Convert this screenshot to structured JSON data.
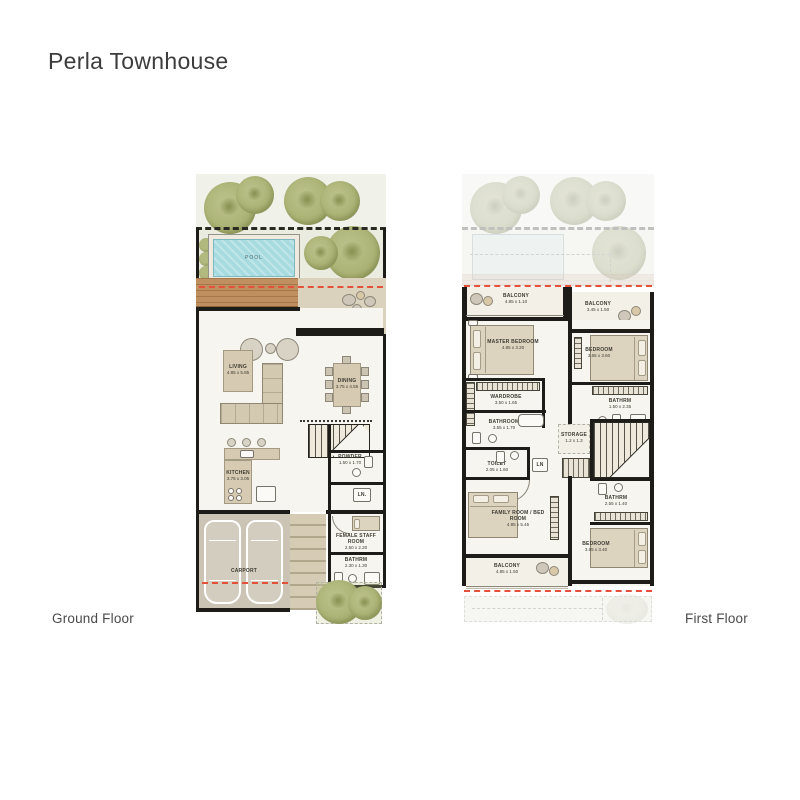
{
  "title": "Perla Townhouse",
  "floors": {
    "ground": {
      "name": "Ground Floor"
    },
    "first": {
      "name": "First Floor"
    }
  },
  "ground": {
    "pool": {
      "label": "POOL"
    },
    "living": {
      "label": "LIVING",
      "dims": "4.85 x 5.85"
    },
    "dining": {
      "label": "DINING",
      "dims": "3.75 x 4.55"
    },
    "kitchen": {
      "label": "KITCHEN",
      "dims": "3.75 x 3.05"
    },
    "powder": {
      "label": "POWDER",
      "dims": "1.50 x 1.70"
    },
    "linen": {
      "label": "LN."
    },
    "staff_room": {
      "label": "FEMALE STAFF ROOM",
      "dims": "2.50 x 2.20"
    },
    "bathroom": {
      "label": "BATHRM",
      "dims": "2.30 x 1.30"
    },
    "carport": {
      "label": "CARPORT"
    }
  },
  "first": {
    "balcony_front": {
      "label": "BALCONY",
      "dims": "4.85 x 1.10"
    },
    "balcony_front_right": {
      "label": "BALCONY",
      "dims": "3.45 x 1.50"
    },
    "master_bedroom": {
      "label": "MASTER BEDROOM",
      "dims": "4.85 x 3.20"
    },
    "bedroom_2": {
      "label": "BEDROOM",
      "dims": "3.65 x 3.60"
    },
    "wardrobe": {
      "label": "WARDROBE",
      "dims": "3.50 x 1.65"
    },
    "bathroom_master": {
      "label": "BATHROOM",
      "dims": "3.55 x 1.70"
    },
    "toilet": {
      "label": "TOILET",
      "dims": "2.05 x 1.60"
    },
    "linen": {
      "label": "LN"
    },
    "storage": {
      "label": "STORAGE",
      "dims": "1.2 x 1.3"
    },
    "bathroom_2": {
      "label": "BATHRM",
      "dims": "1.50 x 2.35"
    },
    "bathroom_3": {
      "label": "BATHRM",
      "dims": "2.55 x 1.40"
    },
    "family_room": {
      "label": "FAMILY ROOM / BED ROOM",
      "dims": "4.85 x 5.45"
    },
    "bedroom_3": {
      "label": "BEDROOM",
      "dims": "3.65 x 3.40"
    },
    "balcony_rear": {
      "label": "BALCONY",
      "dims": "4.85 x 1.50"
    }
  },
  "colors": {
    "accent_red_dash": "#e4503a",
    "pool_water": "#a7dbdf",
    "tree_green": "#aab172",
    "deck_wood": "#c08f5f",
    "wall_black": "#1d1c18",
    "patio_tan": "#dbd2bd"
  }
}
